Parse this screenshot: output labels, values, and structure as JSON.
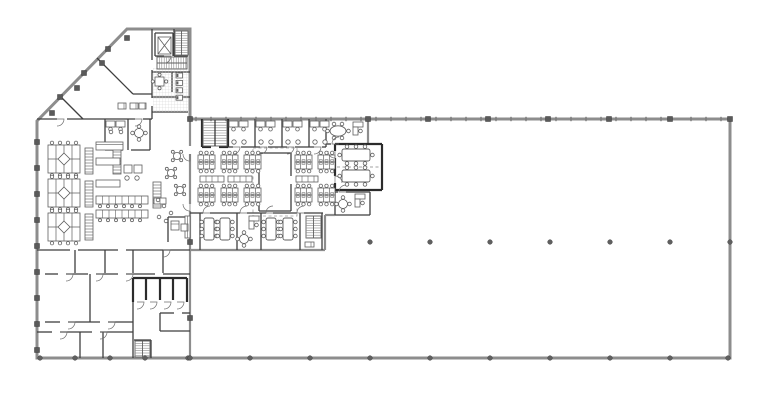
{
  "meta": {
    "title": "office-building-floor-plan",
    "canvas": {
      "w": 768,
      "h": 400
    },
    "colors": {
      "bg": "#ffffff",
      "ext": "#8d8d8d",
      "int": "#3f3f3f",
      "dark": "#2b2b2b",
      "fur": "#5f5f5f",
      "dash": "#a0a0a0",
      "tick": "#7a7a7a",
      "col": "#5a5a5a",
      "dot": "#606060",
      "tile": "#cfcfcf",
      "tread": "#8a8a8a"
    }
  },
  "outline": {
    "points": [
      [
        127,
        29
      ],
      [
        190,
        29
      ],
      [
        190,
        119
      ],
      [
        730,
        119
      ],
      [
        730,
        358
      ],
      [
        37,
        358
      ],
      [
        37,
        121
      ]
    ]
  },
  "walls": [
    [
      190,
      119,
      190,
      146,
      "g"
    ],
    [
      190,
      154,
      190,
      204,
      "g"
    ],
    [
      190,
      211,
      190,
      358,
      "g"
    ],
    [
      190,
      250,
      325,
      250,
      "g"
    ],
    [
      325,
      215,
      325,
      250,
      "g"
    ],
    [
      325,
      215,
      335,
      215,
      "g"
    ],
    [
      368,
      119,
      368,
      144,
      "g"
    ],
    [
      37,
      119,
      57,
      119,
      "i"
    ],
    [
      67,
      119,
      135,
      119,
      "i"
    ],
    [
      143,
      119,
      152,
      119,
      "i"
    ],
    [
      60,
      96,
      83,
      119,
      "i"
    ],
    [
      97,
      58,
      133,
      94,
      "i"
    ],
    [
      133,
      94,
      152,
      94,
      "i"
    ],
    [
      152,
      29,
      152,
      60,
      "i"
    ],
    [
      152,
      70,
      152,
      98,
      "i"
    ],
    [
      152,
      106,
      152,
      119,
      "i"
    ],
    [
      155,
      33,
      173,
      33,
      "i"
    ],
    [
      173,
      33,
      173,
      56,
      "i"
    ],
    [
      155,
      33,
      155,
      56,
      "i"
    ],
    [
      155,
      56,
      164,
      56,
      "i"
    ],
    [
      174,
      29,
      174,
      56,
      "i"
    ],
    [
      174,
      56,
      188,
      56,
      "i"
    ],
    [
      152,
      72,
      190,
      72,
      "i"
    ],
    [
      172,
      72,
      172,
      92,
      "i"
    ],
    [
      152,
      97,
      190,
      97,
      "i"
    ],
    [
      152,
      112,
      188,
      112,
      "i"
    ],
    [
      105,
      119,
      105,
      150,
      "i"
    ],
    [
      128,
      119,
      128,
      150,
      "i"
    ],
    [
      150,
      119,
      150,
      150,
      "i"
    ],
    [
      105,
      150,
      123,
      150,
      "i"
    ],
    [
      131,
      150,
      150,
      150,
      "i"
    ],
    [
      37,
      250,
      70,
      250,
      "i"
    ],
    [
      78,
      250,
      118,
      250,
      "i"
    ],
    [
      126,
      250,
      190,
      250,
      "i"
    ],
    [
      163,
      250,
      163,
      273,
      "i"
    ],
    [
      75,
      250,
      75,
      273,
      "i"
    ],
    [
      105,
      250,
      105,
      273,
      "i"
    ],
    [
      133,
      250,
      133,
      273,
      "i"
    ],
    [
      45,
      274,
      58,
      274,
      "i"
    ],
    [
      66,
      274,
      88,
      274,
      "i"
    ],
    [
      96,
      274,
      118,
      274,
      "i"
    ],
    [
      126,
      274,
      155,
      274,
      "i"
    ],
    [
      163,
      274,
      190,
      274,
      "i"
    ],
    [
      90,
      274,
      90,
      322,
      "i"
    ],
    [
      45,
      322,
      60,
      322,
      "i"
    ],
    [
      68,
      322,
      100,
      322,
      "i"
    ],
    [
      108,
      322,
      133,
      322,
      "i"
    ],
    [
      37,
      332,
      52,
      332,
      "i"
    ],
    [
      60,
      332,
      92,
      332,
      "i"
    ],
    [
      100,
      332,
      133,
      332,
      "i"
    ],
    [
      80,
      332,
      80,
      358,
      "i"
    ],
    [
      103,
      332,
      103,
      358,
      "i"
    ],
    [
      133,
      302,
      133,
      358,
      "i"
    ],
    [
      160,
      313,
      174,
      313,
      "i"
    ],
    [
      182,
      313,
      190,
      313,
      "i"
    ],
    [
      160,
      313,
      160,
      331,
      "i"
    ],
    [
      160,
      331,
      190,
      331,
      "i"
    ],
    [
      168,
      217,
      190,
      217,
      "i"
    ],
    [
      168,
      217,
      168,
      242,
      "i"
    ],
    [
      151,
      340,
      151,
      358,
      "i"
    ],
    [
      134,
      340,
      151,
      340,
      "i"
    ],
    [
      133,
      278,
      187,
      278,
      "d"
    ],
    [
      133,
      278,
      133,
      302,
      "d"
    ],
    [
      146,
      278,
      146,
      300,
      "d"
    ],
    [
      160,
      278,
      160,
      300,
      "d"
    ],
    [
      173,
      278,
      173,
      300,
      "d"
    ],
    [
      187,
      278,
      187,
      302,
      "d"
    ],
    [
      202,
      119,
      202,
      147,
      "d"
    ],
    [
      228,
      119,
      228,
      147,
      "d"
    ],
    [
      202,
      147,
      211,
      147,
      "d"
    ],
    [
      219,
      147,
      228,
      147,
      "d"
    ],
    [
      255,
      119,
      255,
      147,
      "i"
    ],
    [
      282,
      119,
      282,
      147,
      "i"
    ],
    [
      309,
      119,
      309,
      147,
      "i"
    ],
    [
      326,
      119,
      326,
      147,
      "i"
    ],
    [
      228,
      147,
      233,
      147,
      "i"
    ],
    [
      241,
      147,
      260,
      147,
      "i"
    ],
    [
      268,
      147,
      287,
      147,
      "i"
    ],
    [
      295,
      147,
      314,
      147,
      "i"
    ],
    [
      322,
      147,
      326,
      147,
      "i"
    ],
    [
      326,
      144,
      331,
      144,
      "i"
    ],
    [
      339,
      144,
      368,
      144,
      "i"
    ],
    [
      335,
      144,
      382,
      144,
      "d"
    ],
    [
      382,
      144,
      382,
      190,
      "d"
    ],
    [
      335,
      190,
      382,
      190,
      "d"
    ],
    [
      335,
      144,
      335,
      151,
      "d"
    ],
    [
      335,
      158,
      335,
      176,
      "d"
    ],
    [
      335,
      183,
      335,
      190,
      "d"
    ],
    [
      337,
      167,
      380,
      167,
      "dash"
    ],
    [
      335,
      192,
      338,
      192,
      "i"
    ],
    [
      346,
      192,
      370,
      192,
      "i"
    ],
    [
      370,
      192,
      370,
      215,
      "i"
    ],
    [
      335,
      215,
      370,
      215,
      "i"
    ],
    [
      335,
      192,
      335,
      215,
      "i"
    ],
    [
      190,
      213,
      203,
      213,
      "i"
    ],
    [
      210,
      213,
      240,
      213,
      "i"
    ],
    [
      247,
      213,
      266,
      213,
      "i"
    ],
    [
      273,
      213,
      297,
      213,
      "i"
    ],
    [
      304,
      213,
      323,
      213,
      "i"
    ],
    [
      200,
      213,
      200,
      250,
      "i"
    ],
    [
      237,
      213,
      237,
      250,
      "i"
    ],
    [
      261,
      213,
      261,
      250,
      "i"
    ],
    [
      300,
      213,
      300,
      250,
      "i"
    ],
    [
      322,
      213,
      322,
      250,
      "i"
    ],
    [
      259,
      153,
      291,
      153,
      "i"
    ],
    [
      259,
      153,
      259,
      211,
      "i"
    ],
    [
      291,
      153,
      291,
      176,
      "i"
    ],
    [
      291,
      184,
      291,
      211,
      "i"
    ],
    [
      259,
      211,
      291,
      211,
      "i"
    ]
  ],
  "dashrects": [
    [
      253,
      148,
      44,
      68
    ]
  ],
  "columns": {
    "squares": [
      [
        52,
        113
      ],
      [
        77,
        88
      ],
      [
        102,
        63
      ],
      [
        127,
        38
      ],
      [
        60,
        97
      ],
      [
        84,
        73
      ],
      [
        108,
        49
      ],
      [
        37,
        142
      ],
      [
        37,
        168
      ],
      [
        37,
        194
      ],
      [
        37,
        220
      ],
      [
        37,
        246
      ],
      [
        37,
        272
      ],
      [
        37,
        298
      ],
      [
        37,
        324
      ],
      [
        37,
        350
      ],
      [
        190,
        119
      ],
      [
        190,
        242
      ],
      [
        190,
        318
      ],
      [
        368,
        119
      ],
      [
        428,
        119
      ],
      [
        488,
        119
      ],
      [
        548,
        119
      ],
      [
        609,
        119
      ],
      [
        670,
        119
      ],
      [
        730,
        119
      ]
    ],
    "dots": [
      [
        40,
        358
      ],
      [
        75,
        358
      ],
      [
        110,
        358
      ],
      [
        145,
        358
      ],
      [
        188,
        358
      ],
      [
        250,
        358
      ],
      [
        310,
        358
      ],
      [
        370,
        358
      ],
      [
        430,
        358
      ],
      [
        490,
        358
      ],
      [
        550,
        358
      ],
      [
        610,
        358
      ],
      [
        670,
        358
      ],
      [
        728,
        358
      ],
      [
        370,
        242
      ],
      [
        430,
        242
      ],
      [
        490,
        242
      ],
      [
        550,
        242
      ],
      [
        610,
        242
      ],
      [
        670,
        242
      ],
      [
        730,
        242
      ],
      [
        190,
        358
      ]
    ]
  },
  "mullions": {
    "y": 119,
    "x1": 196,
    "x2": 726,
    "step": 15,
    "len": 4.4,
    "avoid": [
      368,
      428,
      488,
      548,
      609,
      670,
      730,
      248,
      308
    ]
  },
  "furniture": [
    [
      "tile",
      153,
      68,
      35,
      44
    ],
    [
      "elev",
      158,
      37,
      13,
      17
    ],
    [
      "stairv",
      175,
      31,
      13,
      24
    ],
    [
      "stairh",
      157,
      57,
      30,
      12
    ],
    [
      "wcrow",
      176,
      73
    ],
    [
      "sqtable",
      155,
      77,
      9,
      9
    ],
    [
      "deskpair",
      106,
      121
    ],
    [
      "chair",
      111,
      132
    ],
    [
      "chair",
      121,
      132
    ],
    [
      "round4",
      139,
      133
    ],
    [
      "cab",
      118,
      103,
      8,
      6
    ],
    [
      "cab",
      130,
      103,
      8,
      6
    ],
    [
      "cab",
      139,
      103,
      7,
      6
    ],
    [
      "podd",
      48,
      145
    ],
    [
      "podd",
      48,
      179
    ],
    [
      "podd",
      48,
      213
    ],
    [
      "shelf",
      85,
      148,
      8,
      26
    ],
    [
      "shelf",
      85,
      181,
      8,
      26
    ],
    [
      "shelf",
      85,
      214,
      8,
      26
    ],
    [
      "shelf",
      113,
      146,
      8,
      28
    ],
    [
      "bench",
      96,
      142,
      27,
      8
    ],
    [
      "lounge",
      96,
      158
    ],
    [
      "benchtbl",
      96,
      196,
      52,
      8
    ],
    [
      "benchtbl",
      96,
      210,
      52,
      8
    ],
    [
      "shelf",
      153,
      182,
      8,
      26
    ],
    [
      "cab",
      154,
      198,
      12,
      6
    ],
    [
      "cafe",
      177,
      156
    ],
    [
      "cafe",
      171,
      173
    ],
    [
      "cafe",
      180,
      190
    ],
    [
      "chair",
      158,
      200
    ],
    [
      "chair",
      164,
      206
    ],
    [
      "chair",
      171,
      213
    ],
    [
      "chair",
      159,
      217
    ],
    [
      "chair",
      166,
      221
    ],
    [
      "counter",
      185,
      216,
      5,
      22
    ],
    [
      "copier",
      171,
      221
    ],
    [
      "cab",
      181,
      224,
      7,
      7
    ],
    [
      "stairdv",
      203,
      120,
      24,
      26
    ],
    [
      "offdesk",
      229,
      121
    ],
    [
      "offdesk",
      256,
      121
    ],
    [
      "offdesk",
      283,
      121
    ],
    [
      "offdesk",
      310,
      121
    ],
    [
      "pod6",
      198,
      155
    ],
    [
      "pod6",
      221,
      155
    ],
    [
      "pod6",
      244,
      155
    ],
    [
      "pod6",
      198,
      188
    ],
    [
      "pod6",
      221,
      188
    ],
    [
      "pod6",
      244,
      188
    ],
    [
      "pod6",
      295,
      155
    ],
    [
      "pod6",
      318,
      155
    ],
    [
      "pod6",
      295,
      188
    ],
    [
      "pod6",
      318,
      188
    ],
    [
      "cab",
      200,
      176,
      24,
      6
    ],
    [
      "cab",
      228,
      176,
      24,
      6
    ],
    [
      "cab",
      296,
      176,
      22,
      6
    ],
    [
      "oval6",
      338,
      131
    ],
    [
      "ldesk",
      353,
      122
    ],
    [
      "confh",
      342,
      149
    ],
    [
      "confh",
      342,
      170
    ],
    [
      "round4",
      343,
      204
    ],
    [
      "ldesk",
      355,
      194
    ],
    [
      "confv",
      204,
      218
    ],
    [
      "confv",
      220,
      218
    ],
    [
      "confv",
      266,
      218
    ],
    [
      "confv",
      283,
      218
    ],
    [
      "round4",
      244,
      239
    ],
    [
      "ldesk",
      249,
      216
    ],
    [
      "stairv",
      306,
      216,
      15,
      22
    ],
    [
      "cab",
      305,
      242,
      9,
      5
    ],
    [
      "stairv",
      135,
      341,
      15,
      16
    ]
  ],
  "doors": [
    [
      137,
      302,
      0
    ],
    [
      150,
      302,
      0
    ],
    [
      164,
      302,
      0
    ],
    [
      177,
      302,
      0
    ],
    [
      233,
      147,
      0
    ],
    [
      260,
      147,
      0
    ],
    [
      287,
      147,
      0
    ],
    [
      314,
      147,
      0
    ],
    [
      210,
      213,
      180
    ],
    [
      247,
      213,
      180
    ],
    [
      273,
      213,
      180
    ],
    [
      304,
      213,
      180
    ],
    [
      66,
      274,
      0
    ],
    [
      96,
      274,
      0
    ],
    [
      126,
      274,
      0
    ],
    [
      68,
      322,
      0
    ],
    [
      108,
      322,
      0
    ],
    [
      60,
      332,
      0
    ],
    [
      100,
      332,
      0
    ],
    [
      339,
      144,
      180
    ],
    [
      346,
      192,
      180
    ],
    [
      335,
      151,
      90
    ],
    [
      335,
      183,
      270
    ],
    [
      164,
      56,
      0
    ],
    [
      57,
      119,
      0
    ],
    [
      135,
      119,
      0
    ],
    [
      190,
      154,
      90
    ],
    [
      190,
      204,
      90
    ],
    [
      163,
      250,
      0
    ]
  ]
}
